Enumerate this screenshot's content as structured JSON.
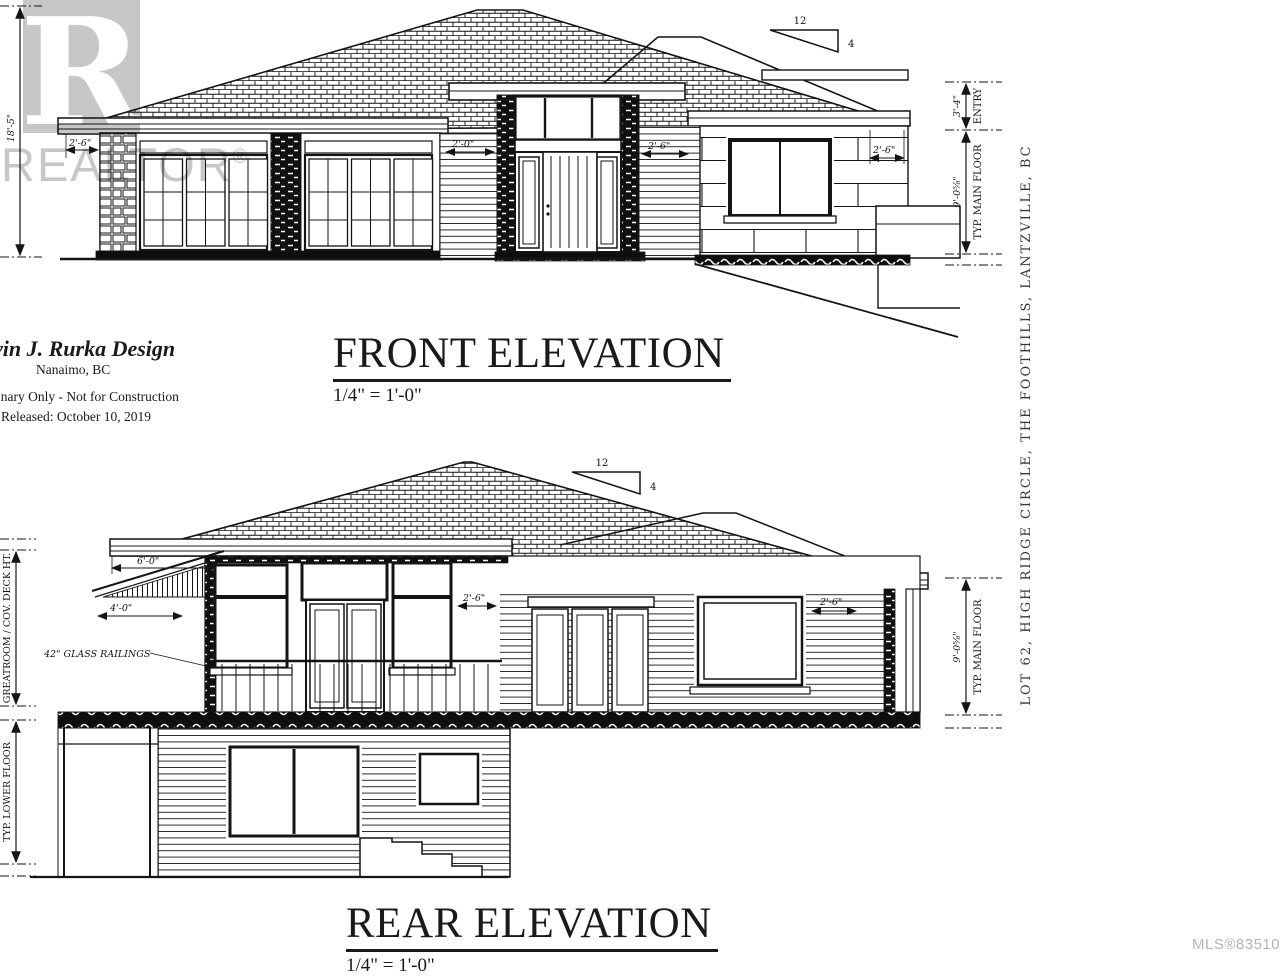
{
  "watermark": {
    "logo_letter": "R",
    "brand": "REALTOR",
    "reg": "®"
  },
  "titles": {
    "front": {
      "title": "FRONT ELEVATION",
      "scale": "1/4\" = 1'-0\""
    },
    "rear": {
      "title": "REAR ELEVATION",
      "scale": "1/4\" = 1'-0\""
    }
  },
  "titleblock": {
    "designer": "vin J. Rurka Design",
    "city": "Nanaimo, BC",
    "disclaimer": "inary Only - Not for Construction",
    "released": "Released: October 10, 2019"
  },
  "front_dims": {
    "left_height": "18'-5\"",
    "slope_run": "12",
    "slope_rise": "4",
    "garage_overhang": "2'-6\"",
    "entry_left": "2'-0\"",
    "entry_right": "2'-6\"",
    "right_overhang": "2'-6\"",
    "entry_height": "3'-4\"",
    "entry_label": "ENTRY",
    "main_height": "9'-0⅝\"",
    "main_floor_label": "TYP. MAIN FLOOR"
  },
  "rear_dims": {
    "slope_run": "12",
    "slope_rise": "4",
    "eave_depth": "6'-0\"",
    "deck_depth": "4'-0\"",
    "center_overhang": "2'-6\"",
    "right_overhang": "2'-6\"",
    "railings_label": "42\" GLASS RAILINGS",
    "greatroom_label": "GREATROOM / COV. DECK HT.",
    "lower_floor_label": "TYP. LOWER FLOOR",
    "main_height": "9'-0⅝\"",
    "main_floor_label": "TYP. MAIN FLOOR"
  },
  "side_note": "LOT 62, HIGH RIDGE CIRCLE, THE FOOTHILLS, LANTZVILLE, BC",
  "mls_number": "MLS®835108",
  "colors": {
    "ink": "#141414",
    "watermark": "#c7c7c7",
    "mls_gray": "#b0b4b8",
    "paper": "#ffffff"
  }
}
